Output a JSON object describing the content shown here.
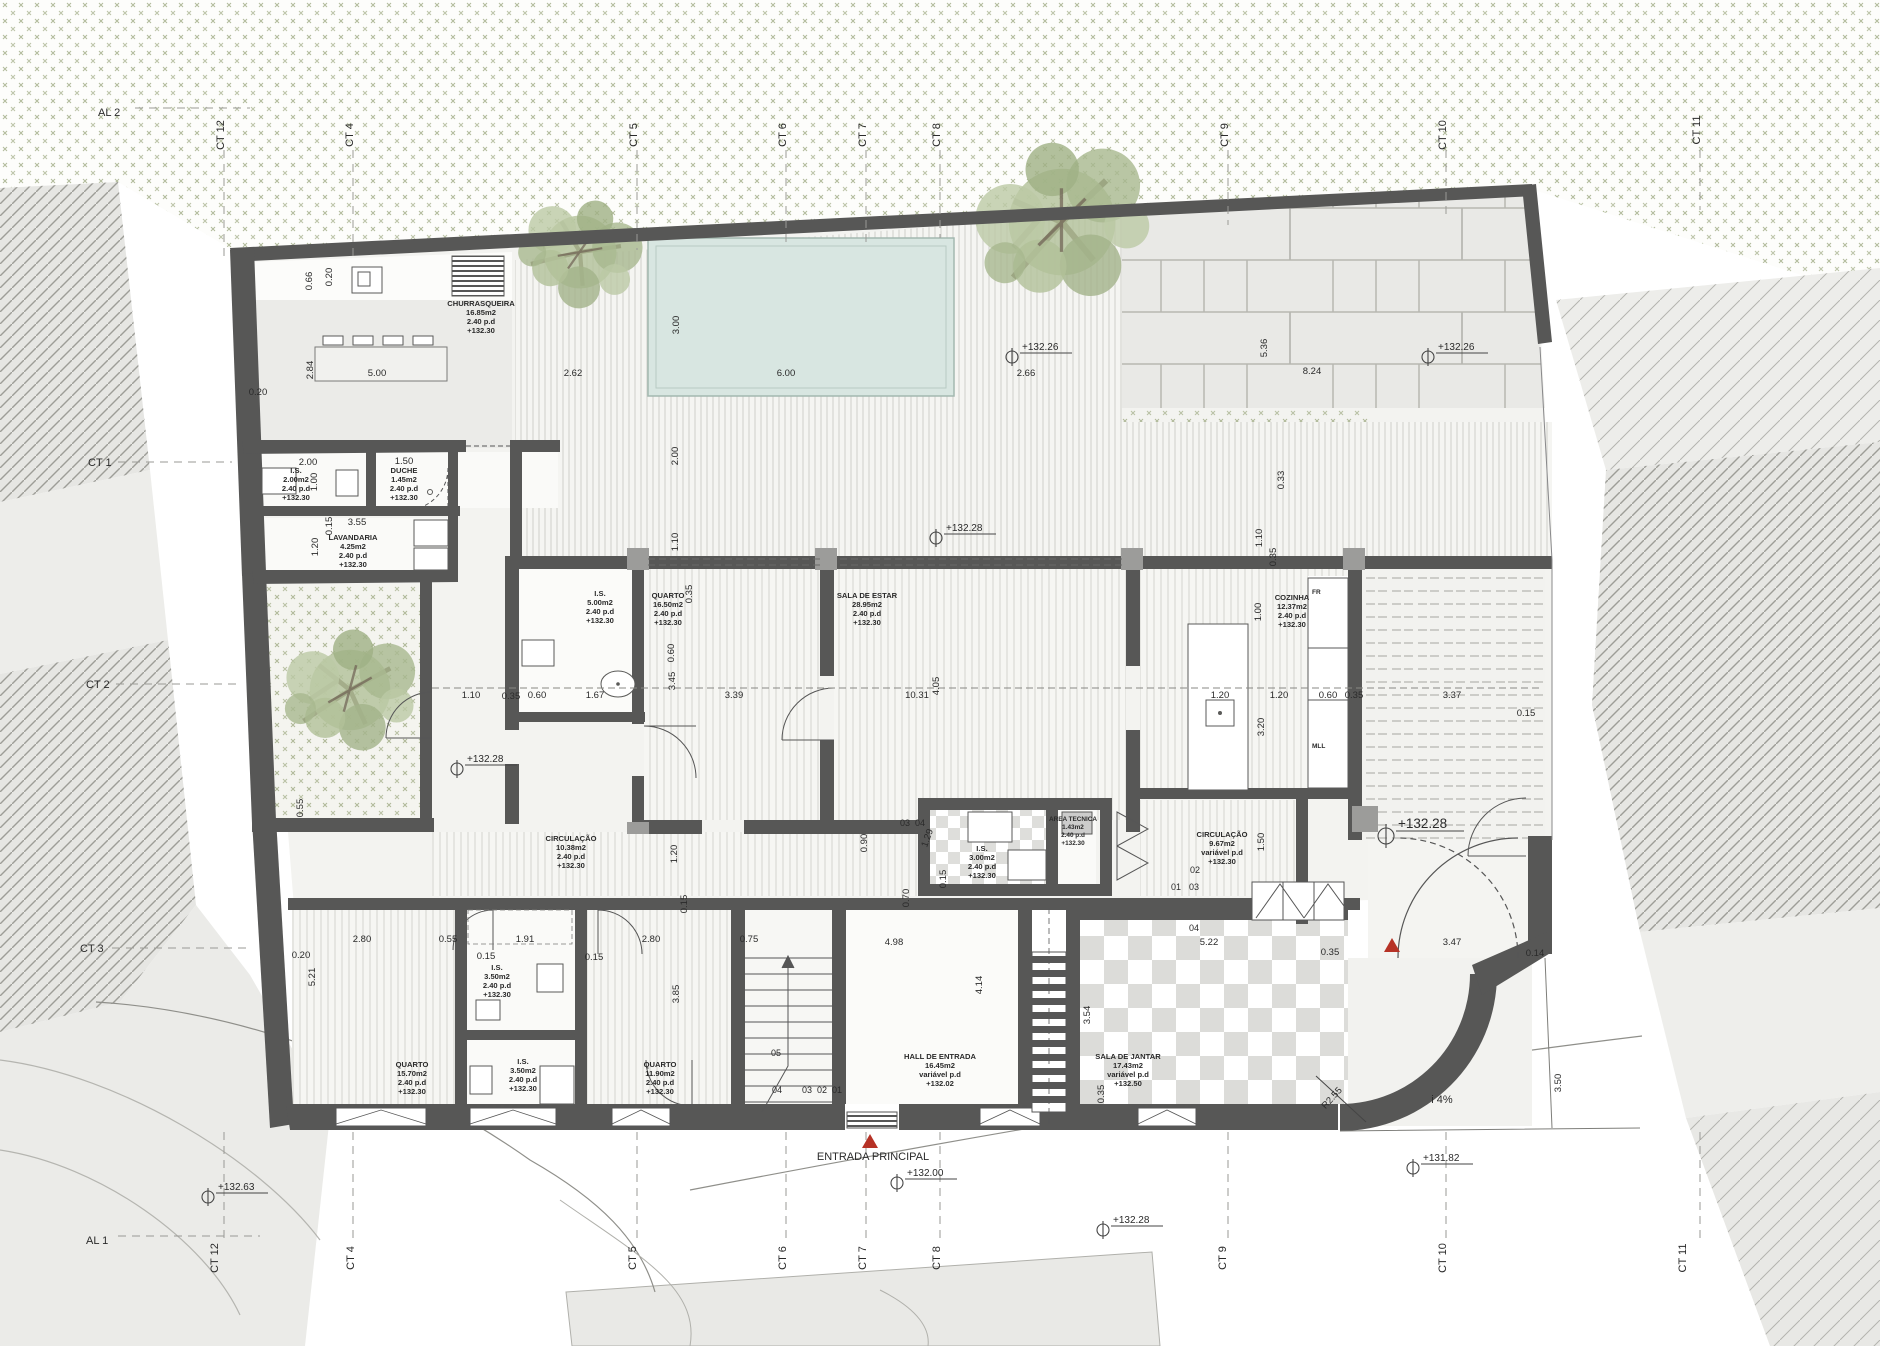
{
  "drawing": {
    "type": "architectural-floor-plan",
    "entrance_label": "ENTRADA PRINCIPAL",
    "slope_label": "i 4%",
    "radius_label": "R2.55",
    "fridge_label": "FR",
    "dishwasher_label": "MLL"
  },
  "colors": {
    "wall": "#575756",
    "pool": "#d8e6e1",
    "vegetation": "#97a478",
    "accent_red": "#b63226",
    "floor_gray": "#ebebe8",
    "paper": "#ffffff"
  },
  "grid": {
    "top": [
      "AL 2",
      "CT 12",
      "CT 4",
      "CT 5",
      "CT 6",
      "CT 7",
      "CT 8",
      "CT 9",
      "CT 10",
      "CT 11"
    ],
    "left": [
      "CT 1",
      "CT 2",
      "CT 3"
    ],
    "bottom": [
      "AL 1",
      "CT 12",
      "CT 4",
      "CT 5",
      "CT 6",
      "CT 7",
      "CT 8",
      "CT 9",
      "CT 10",
      "CT 11"
    ]
  },
  "rooms": [
    {
      "n": "CHURRASQUEIRA",
      "a": "16.85m2",
      "h": "2.40  p.d",
      "l": "+132.30"
    },
    {
      "n": "I.S.",
      "a": "2.00m2",
      "h": "2.40  p.d",
      "l": "+132.30"
    },
    {
      "n": "DUCHE",
      "a": "1.45m2",
      "h": "2.40  p.d",
      "l": "+132.30"
    },
    {
      "n": "LAVANDARIA",
      "a": "4.25m2",
      "h": "2.40  p.d",
      "l": "+132.30"
    },
    {
      "n": "I.S.",
      "a": "5.00m2",
      "h": "2.40  p.d",
      "l": "+132.30"
    },
    {
      "n": "QUARTO",
      "a": "16.50m2",
      "h": "2.40  p.d",
      "l": "+132.30"
    },
    {
      "n": "SALA  DE  ESTAR",
      "a": "28.95m2",
      "h": "2.40  p.d",
      "l": "+132.30"
    },
    {
      "n": "COZINHA",
      "a": "12.37m2",
      "h": "2.40  p.d",
      "l": "+132.30"
    },
    {
      "n": "CIRCULAÇÃO",
      "a": "10.38m2",
      "h": "2.40  p.d",
      "l": "+132.30"
    },
    {
      "n": "I.S.",
      "a": "3.00m2",
      "h": "2.40  p.d",
      "l": "+132.30"
    },
    {
      "n": "AREA TECNICA",
      "a": "1.43m2",
      "h": "2.40  p.d",
      "l": "+132.30"
    },
    {
      "n": "CIRCULAÇÃO",
      "a": "9.67m2",
      "h": "variável  p.d",
      "l": "+132.30"
    },
    {
      "n": "QUARTO",
      "a": "15.70m2",
      "h": "2.40  p.d",
      "l": "+132.30"
    },
    {
      "n": "I.S.",
      "a": "3.50m2",
      "h": "2.40  p.d",
      "l": "+132.30"
    },
    {
      "n": "I.S.",
      "a": "3.50m2",
      "h": "2.40  p.d",
      "l": "+132.30"
    },
    {
      "n": "QUARTO",
      "a": "11.90m2",
      "h": "2.40  p.d",
      "l": "+132.30"
    },
    {
      "n": "HALL  DE  ENTRADA",
      "a": "16.45m2",
      "h": "variável  p.d",
      "l": "+132.02"
    },
    {
      "n": "SALA  DE  JANTAR",
      "a": "17.43m2",
      "h": "variável  p.d",
      "l": "+132.50"
    }
  ],
  "levels": [
    "+132.26",
    "+132.26",
    "+132.28",
    "+132.28",
    "+132.28",
    "+132.00",
    "+132.28",
    "+132.63",
    "+131.82"
  ],
  "dims": [
    "0.66",
    "0.20",
    "0.20",
    "2.84",
    "5.00",
    "2.62",
    "6.00",
    "2.66",
    "8.24",
    "5.36",
    "0.33",
    "3.00",
    "2.00",
    "1.10",
    "1.10",
    "0.35",
    "1.00",
    "2.00",
    "1.50",
    "1.00",
    "0.15",
    "3.55",
    "1.20",
    "1.10",
    "0.35",
    "0.60",
    "1.67",
    "3.45",
    "3.39",
    "10.31",
    "4.05",
    "1.20",
    "1.20",
    "0.60",
    "0.35",
    "3.37",
    "0.15",
    "3.20",
    "0.55",
    "0.60",
    "1.20",
    "0.15",
    "0.90",
    "1.29",
    "0.15",
    "0.70",
    "1.50",
    "0.20",
    "2.80",
    "0.55",
    "1.91",
    "0.15",
    "0.15",
    "2.80",
    "0.75",
    "4.98",
    "5.22",
    "0.35",
    "3.47",
    "0.14",
    "5.21",
    "3.85",
    "4.14",
    "3.54",
    "0.35",
    "3.50",
    "0.35",
    "04",
    "03",
    "04",
    "02",
    "01",
    "03",
    "05",
    "04",
    "03",
    "02",
    "01"
  ]
}
